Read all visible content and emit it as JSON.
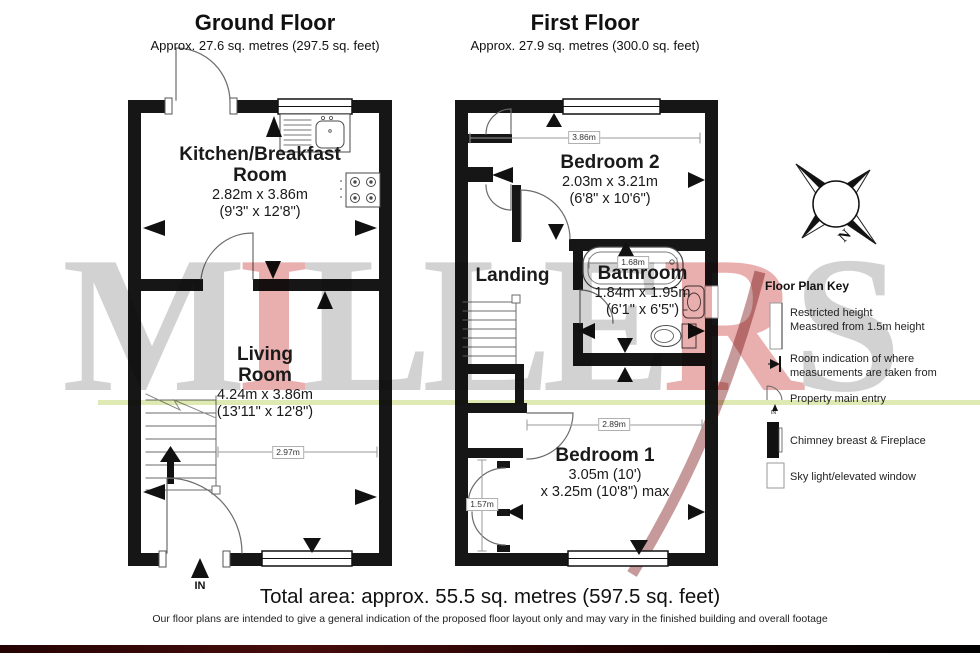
{
  "watermark": {
    "text": "MILLERS",
    "letters": [
      "M",
      "I",
      "L",
      "L",
      "E",
      "R",
      "S"
    ],
    "gray_color": "#d2d2d2",
    "red_color": "#e9aeae"
  },
  "ground_floor": {
    "title": "Ground Floor",
    "subtitle": "Approx. 27.6 sq. metres (297.5 sq. feet)",
    "kitchen": {
      "name_line1": "Kitchen/Breakfast",
      "name_line2": "Room",
      "dims_metric": "2.82m x 3.86m",
      "dims_imperial": "(9'3\" x 12'8\")"
    },
    "living": {
      "name_line1": "Living",
      "name_line2": "Room",
      "dims_metric": "4.24m x 3.86m",
      "dims_imperial": "(13'11\" x 12'8\")"
    },
    "dim_width": "2.97m",
    "entry_label": "IN"
  },
  "first_floor": {
    "title": "First Floor",
    "subtitle": "Approx. 27.9 sq. metres (300.0 sq. feet)",
    "bedroom2": {
      "name": "Bedroom 2",
      "dims_metric": "2.03m x 3.21m",
      "dims_imperial": "(6'8\" x 10'6\")"
    },
    "landing": {
      "name": "Landing"
    },
    "bathroom": {
      "name": "Bathroom",
      "dims_metric": "1.84m x 1.95m",
      "dims_imperial": "(6'1\" x 6'5\")"
    },
    "bedroom1": {
      "name": "Bedroom 1",
      "dims_line1": "3.05m (10')",
      "dims_line2": "x 3.25m (10'8\") max"
    },
    "dim_top": "3.86m",
    "dim_bath": "1.68m",
    "dim_bed1_width": "2.89m",
    "dim_bed1_depth": "1.57m"
  },
  "compass": {
    "north": "N"
  },
  "legend": {
    "title": "Floor Plan Key",
    "items": [
      {
        "line1": "Restricted height",
        "line2": "Measured from 1.5m height"
      },
      {
        "line1": "Room indication of where",
        "line2": "measurements are taken from"
      },
      {
        "line1": "Property main entry",
        "line2": ""
      },
      {
        "line1": "Chimney breast & Fireplace",
        "line2": ""
      },
      {
        "line1": "Sky light/elevated window",
        "line2": ""
      }
    ],
    "entry_icon_text": "IN"
  },
  "footer": {
    "total": "Total area: approx. 55.5 sq. metres (597.5 sq. feet)",
    "disclaimer": "Our floor plans are intended to give a general indication of the proposed floor layout only and may vary in the finished building and overall footage"
  }
}
